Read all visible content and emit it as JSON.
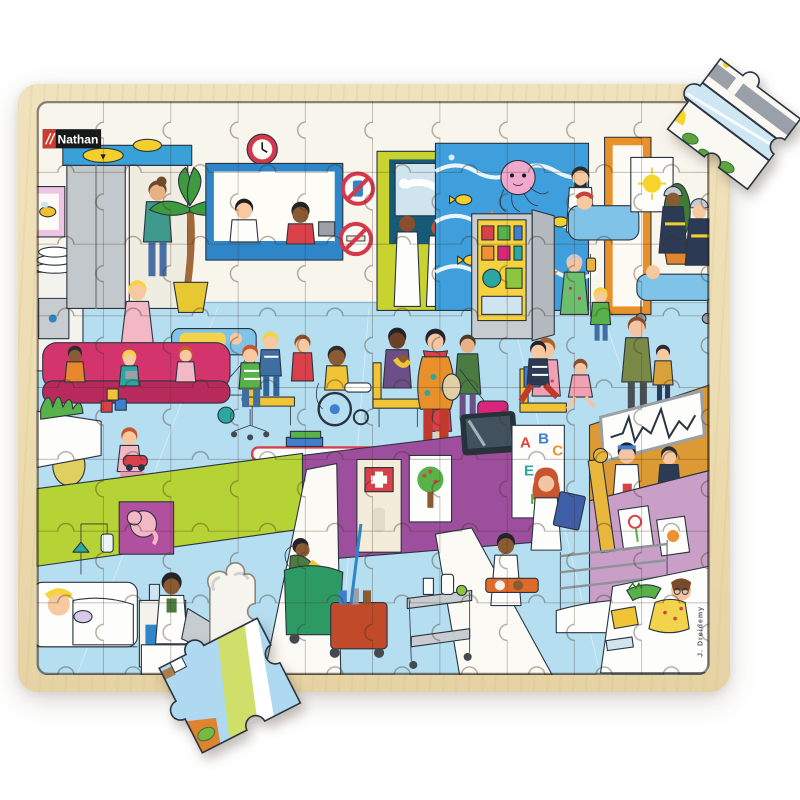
{
  "product": {
    "description": "Top-down photo of a wooden tray jigsaw puzzle (~96 pieces) depicting a crowded cartoon children's hospital: elevators, reception desk, X-ray room, sea-life mural with a pink octopus, vending machine, firefighters with a stretcher, waiting-area sofa and toys, patient rooms with beds, a cleaning cart and doctors. One piece gap is open near the bottom-left, one loose piece lies tilted over the bottom frame edge, and one lifted piece rests on the top-right corner of the frame.",
    "brand_logo": "Nathan",
    "illustrator_signature": "J. Dreidemy"
  },
  "elevator": {
    "down_arrow": "▼"
  },
  "abc_board": {
    "letters": [
      "A",
      "B",
      "C",
      "E",
      "F",
      "H"
    ],
    "letter_colors": [
      "#e04438",
      "#3e7fd0",
      "#f09030",
      "#2aa7a0",
      "#e05a9d",
      "#58b24a"
    ]
  },
  "colors": {
    "background": "#ffffff",
    "wood": "#eddcb0",
    "wall": "#f8f5ec",
    "floor": "#b5def1",
    "logo_black": "#17181a",
    "logo_red": "#cf3a31",
    "aquarium_blue": "#3f9fdc",
    "octopus_pink": "#f0a9cc",
    "xray_room_green": "#c9d32f",
    "vending_yellow": "#f6d23e",
    "sofa_magenta": "#d2346b",
    "ward_wall_green": "#b6d335",
    "corridor_wall_purple": "#9d4f9e",
    "monitor_wall_orange": "#db9a34",
    "nursery_wall_mauve": "#c99fc8",
    "suitcase_pink": "#d9267a"
  }
}
